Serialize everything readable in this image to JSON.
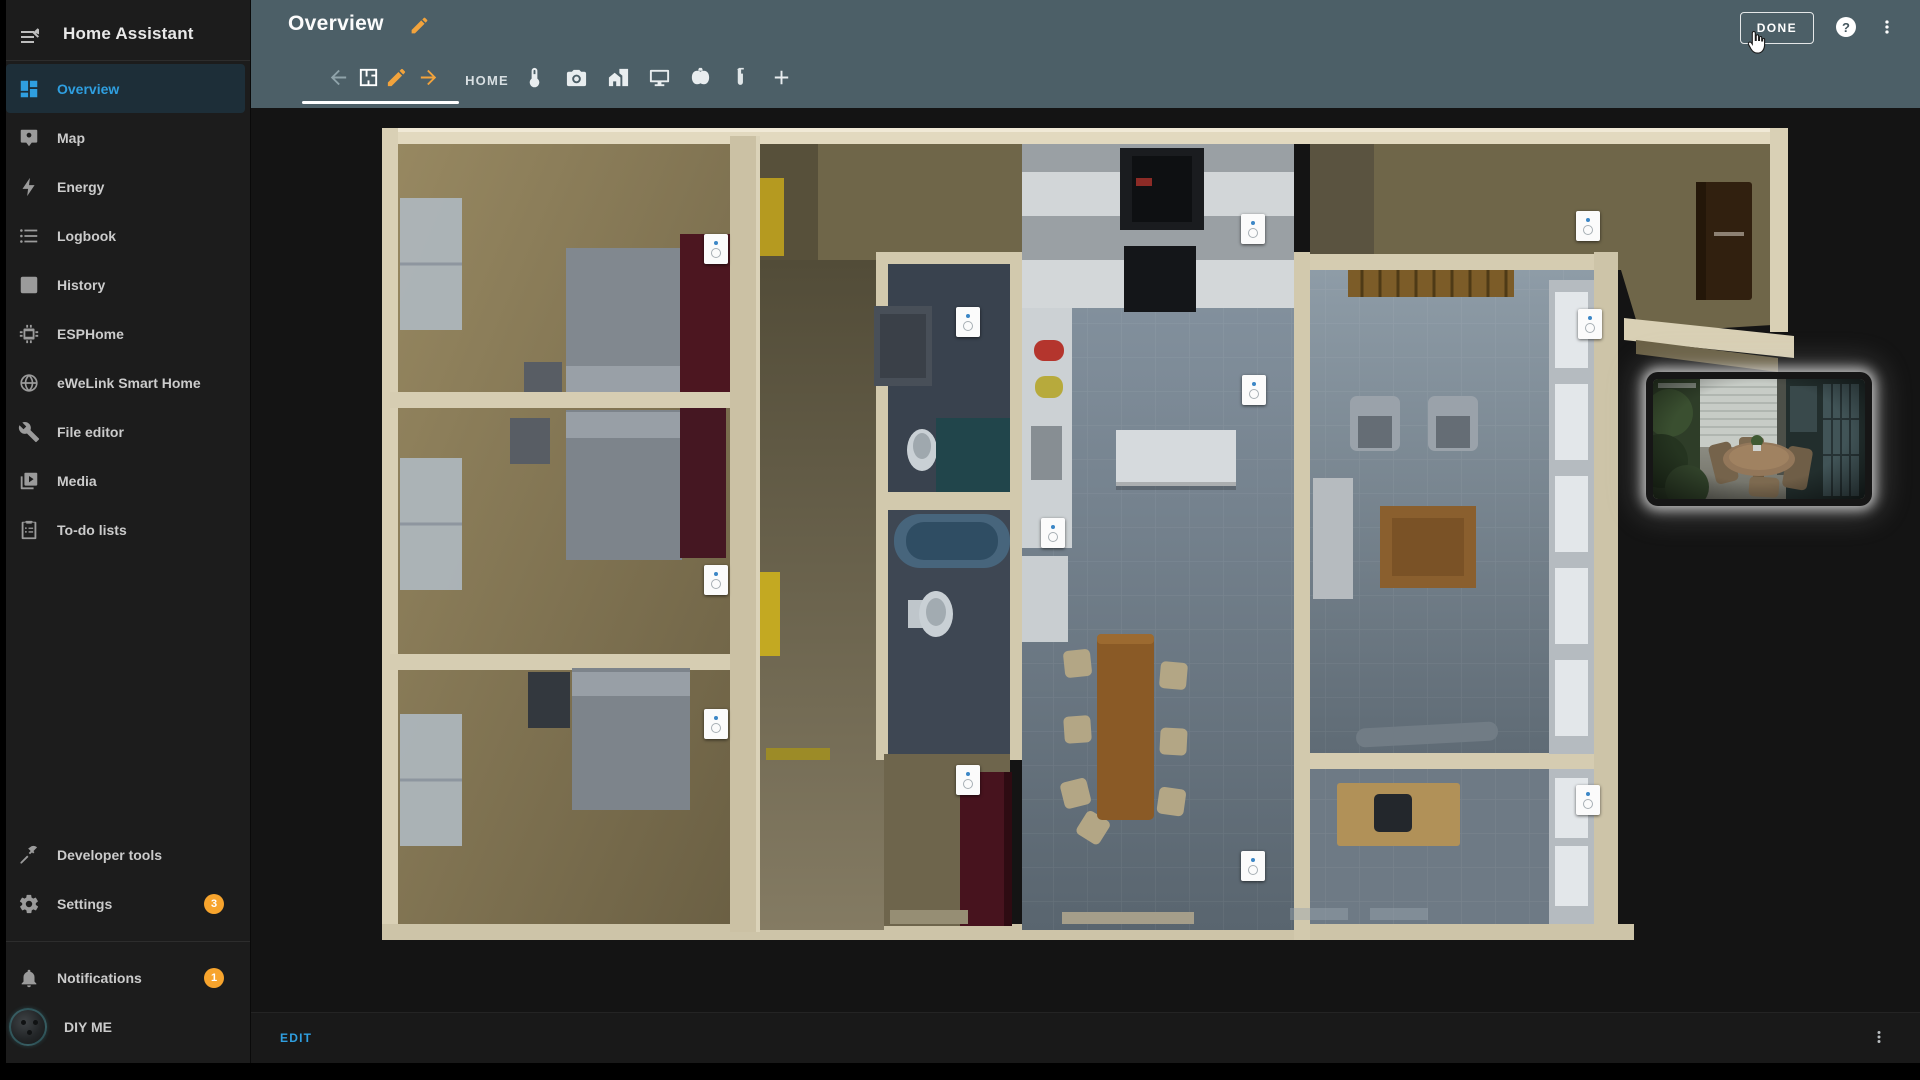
{
  "app": {
    "title": "Home Assistant"
  },
  "sidebar": {
    "items": [
      {
        "label": "Overview",
        "icon": "view-dashboard-icon",
        "active": true
      },
      {
        "label": "Map",
        "icon": "map-account-icon"
      },
      {
        "label": "Energy",
        "icon": "lightning-bolt-icon"
      },
      {
        "label": "Logbook",
        "icon": "format-list-icon"
      },
      {
        "label": "History",
        "icon": "chart-box-icon"
      },
      {
        "label": "ESPHome",
        "icon": "chip-icon"
      },
      {
        "label": "eWeLink Smart Home",
        "icon": "globe-icon"
      },
      {
        "label": "File editor",
        "icon": "wrench-icon"
      },
      {
        "label": "Media",
        "icon": "play-box-icon"
      },
      {
        "label": "To-do lists",
        "icon": "clipboard-list-icon"
      }
    ],
    "secondary": [
      {
        "label": "Developer tools",
        "icon": "hammer-icon"
      },
      {
        "label": "Settings",
        "icon": "cog-icon",
        "badge": "3"
      }
    ],
    "footer": [
      {
        "label": "Notifications",
        "icon": "bell-icon",
        "badge": "1"
      },
      {
        "label": "DIY ME",
        "avatar": true
      }
    ]
  },
  "header": {
    "title": "Overview",
    "done_label": "DONE",
    "help_glyph": "?"
  },
  "tabs": {
    "items": [
      {
        "name": "move-view-left",
        "icon": "arrow-left-icon",
        "color": "muted"
      },
      {
        "name": "tab-floorplan",
        "icon": "floor-plan-icon",
        "color": "white",
        "active": true
      },
      {
        "name": "edit-view",
        "icon": "pencil-icon",
        "color": "accent"
      },
      {
        "name": "move-view-right",
        "icon": "arrow-right-icon",
        "color": "accent"
      },
      {
        "name": "tab-home",
        "label": "HOME"
      },
      {
        "name": "tab-thermometer",
        "icon": "thermometer-icon"
      },
      {
        "name": "tab-cameras",
        "icon": "camera-icon"
      },
      {
        "name": "tab-house",
        "icon": "home-city-icon"
      },
      {
        "name": "tab-media",
        "icon": "monitor-icon"
      },
      {
        "name": "tab-halloween",
        "icon": "pumpkin-icon"
      },
      {
        "name": "tab-lab",
        "icon": "test-tube-icon"
      },
      {
        "name": "add-view",
        "icon": "plus-icon"
      }
    ]
  },
  "floorplan": {
    "sensors": [
      {
        "name": "bedroom-1",
        "x": 342,
        "y": 129
      },
      {
        "name": "bedroom-2",
        "x": 342,
        "y": 460
      },
      {
        "name": "bedroom-3",
        "x": 342,
        "y": 604
      },
      {
        "name": "bathroom",
        "x": 594,
        "y": 202
      },
      {
        "name": "kitchen",
        "x": 679,
        "y": 413
      },
      {
        "name": "hallway",
        "x": 594,
        "y": 660
      },
      {
        "name": "kitchen-top",
        "x": 879,
        "y": 109
      },
      {
        "name": "kitchen-island",
        "x": 880,
        "y": 270
      },
      {
        "name": "dining",
        "x": 879,
        "y": 746
      },
      {
        "name": "entry",
        "x": 1214,
        "y": 106
      },
      {
        "name": "living-room",
        "x": 1216,
        "y": 204
      },
      {
        "name": "office",
        "x": 1214,
        "y": 680
      }
    ]
  },
  "footer_bar": {
    "edit_label": "EDIT"
  },
  "colors": {
    "header_teal": "#4c5f67",
    "accent_orange": "#f2a33c",
    "accent_blue": "#2f9fe0",
    "badge_orange": "#f7a42d",
    "sidebar_bg": "#1c1c1c",
    "content_bg": "#141414"
  }
}
